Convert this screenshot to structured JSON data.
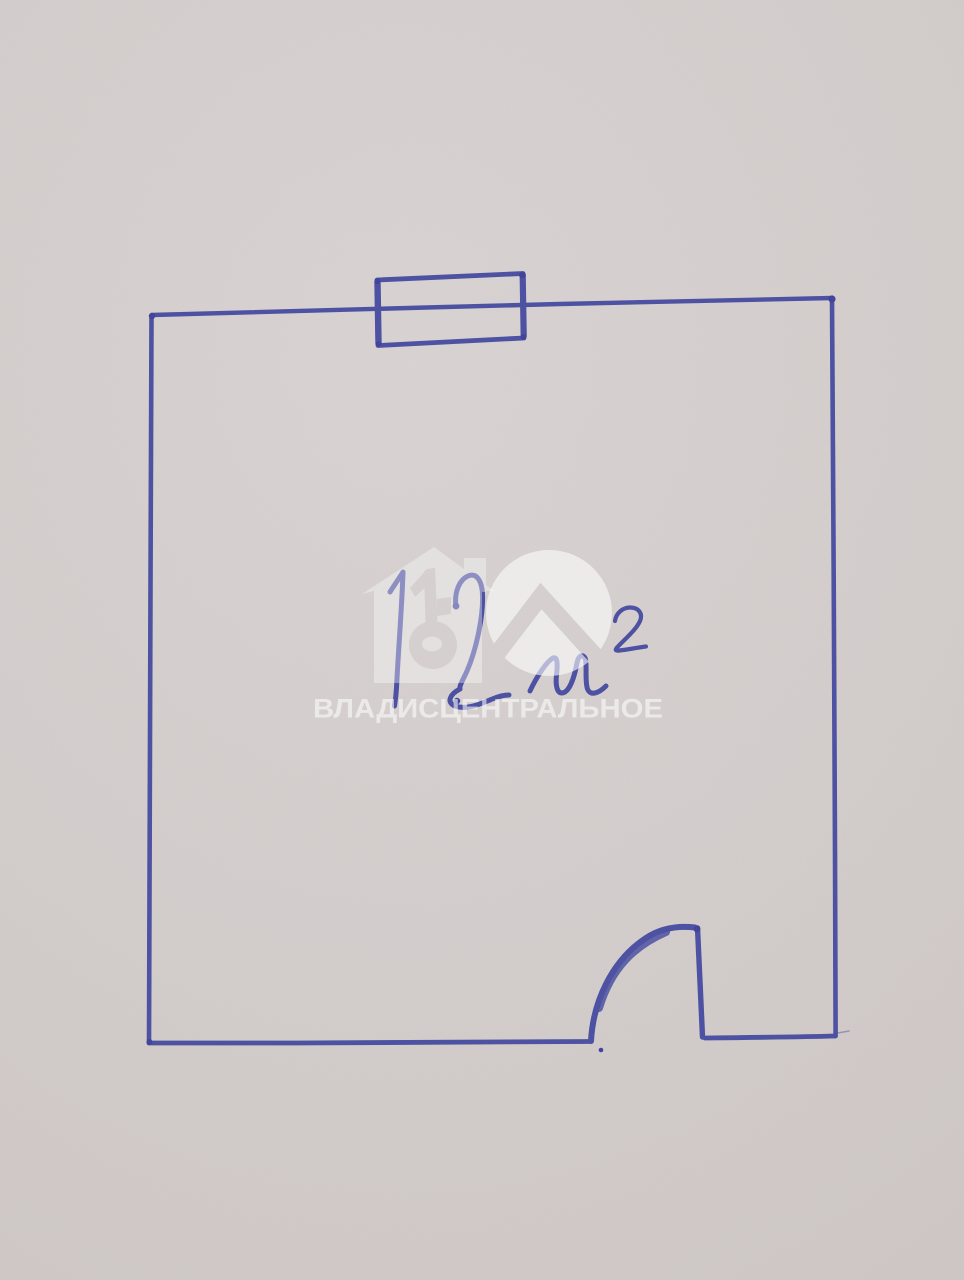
{
  "floor_plan": {
    "area_label": "12 м²",
    "area_value": "12",
    "area_unit": "м²",
    "elements": [
      "room",
      "window",
      "door"
    ]
  },
  "watermark": {
    "label": "ВЛАДИСЦЕНТРАЛЬНОЕ",
    "logo_icons": [
      "house-key-icon",
      "circle-roof-icon"
    ]
  },
  "colors": {
    "pen": "#4b4fa1",
    "pen_dark": "#3f4399",
    "paper": "#d2cccb",
    "watermark": "#ffffff"
  }
}
